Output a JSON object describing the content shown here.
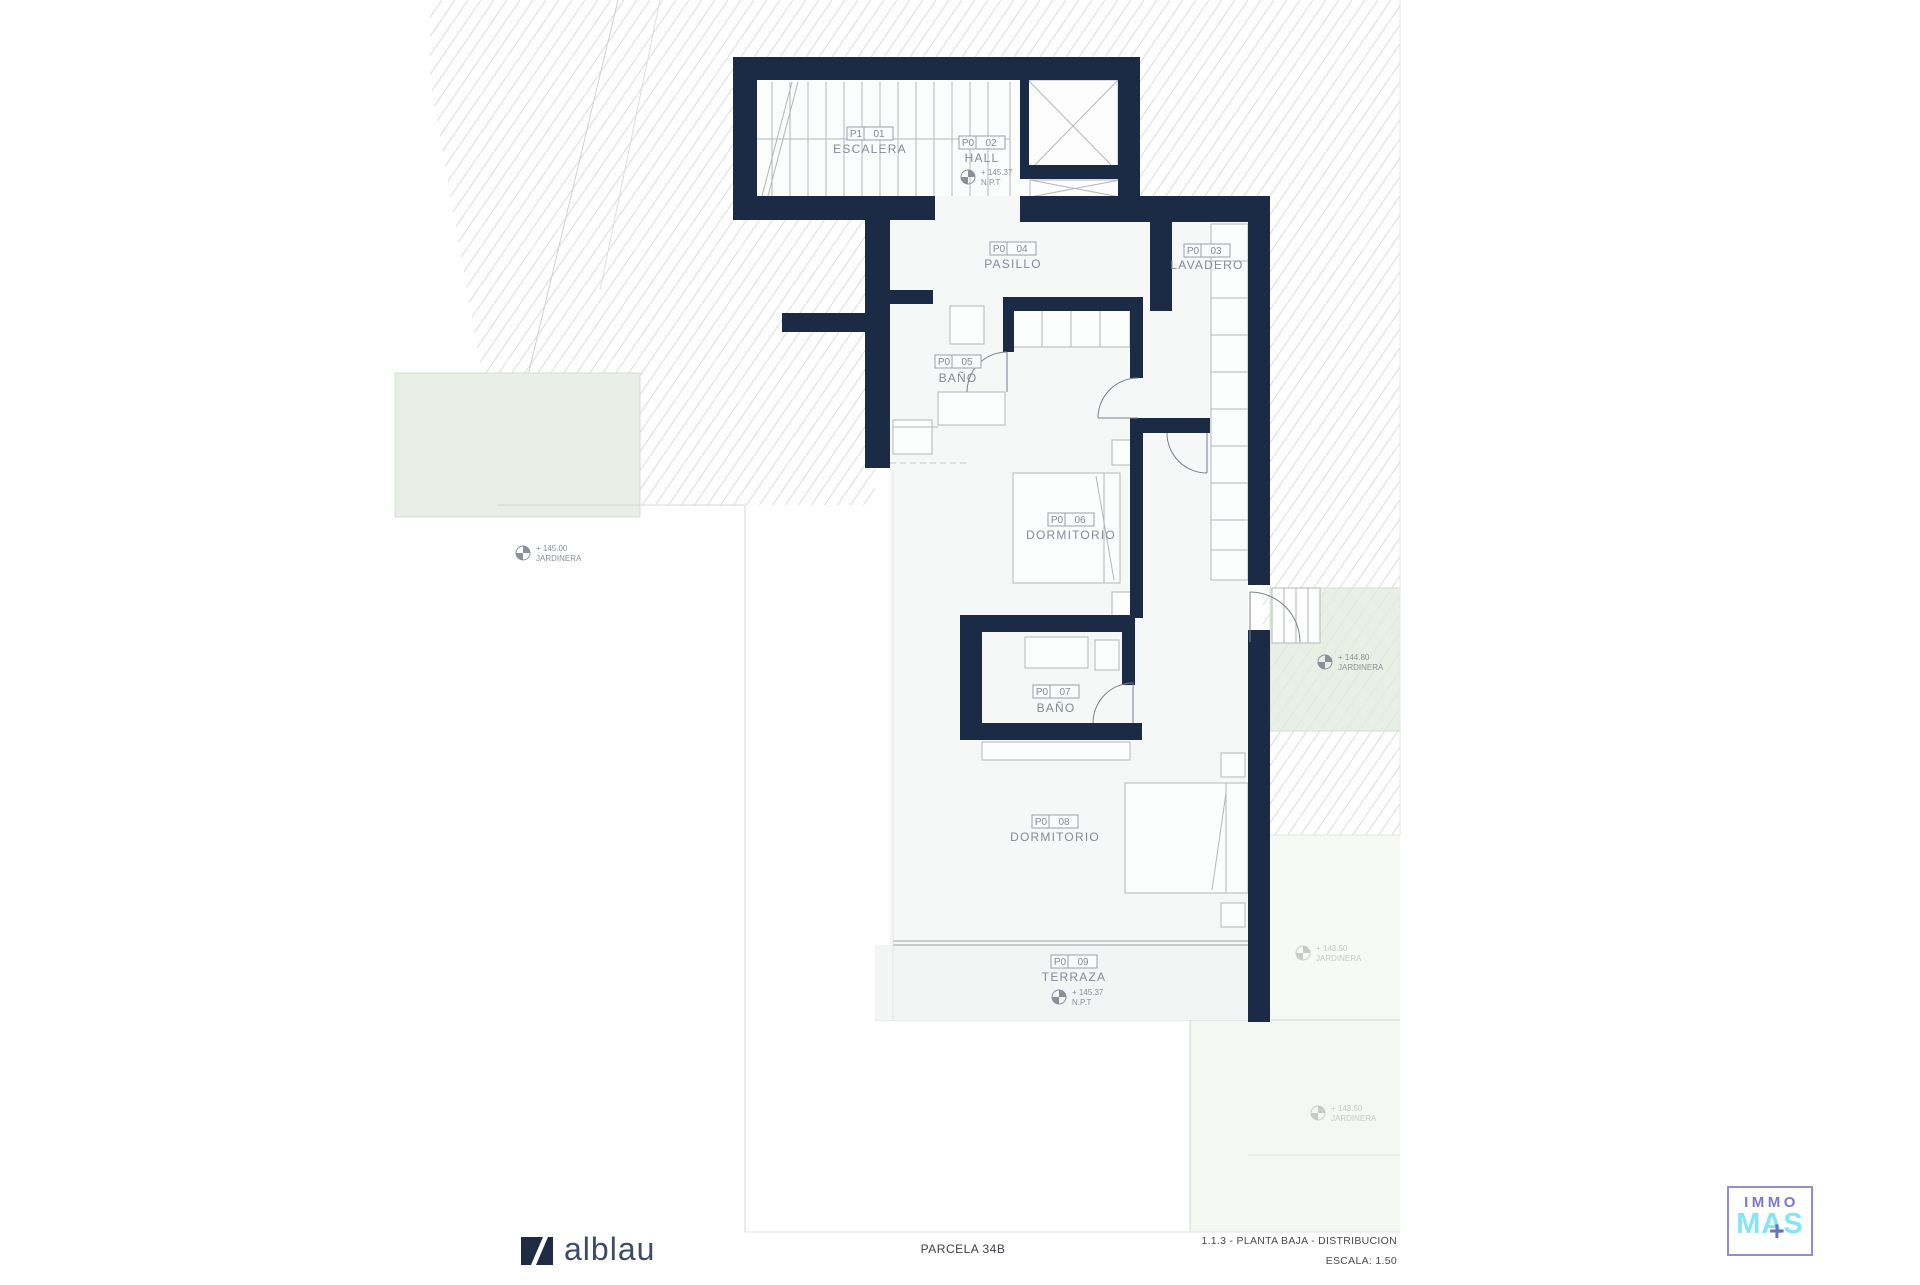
{
  "plan": {
    "rooms": [
      {
        "code": "P1",
        "num": "01",
        "name": "ESCALERA"
      },
      {
        "code": "P0",
        "num": "02",
        "name": "HALL"
      },
      {
        "code": "P0",
        "num": "03",
        "name": "LAVADERO"
      },
      {
        "code": "P0",
        "num": "04",
        "name": "PASILLO"
      },
      {
        "code": "P0",
        "num": "05",
        "name": "BAÑO"
      },
      {
        "code": "P0",
        "num": "06",
        "name": "DORMITORIO"
      },
      {
        "code": "P0",
        "num": "07",
        "name": "BAÑO"
      },
      {
        "code": "P0",
        "num": "08",
        "name": "DORMITORIO"
      },
      {
        "code": "P0",
        "num": "09",
        "name": "TERRAZA"
      }
    ],
    "levels": [
      {
        "value": "+ 145.37",
        "label": "N.P.T"
      },
      {
        "value": "+ 145.37",
        "label": "N.P.T"
      },
      {
        "value": "+ 145.00",
        "label": "JARDINERA"
      },
      {
        "value": "+ 144.80",
        "label": "JARDINERA"
      },
      {
        "value": "+ 143.50",
        "label": "JARDINERA"
      },
      {
        "value": "+ 143.50",
        "label": "JARDINERA"
      }
    ]
  },
  "titleblock": {
    "brand": "alblau",
    "parcel": "PARCELA 34B",
    "sheet": "1.1.3 - PLANTA BAJA - DISTRIBUCION",
    "scale": "ESCALA: 1.50"
  },
  "watermark": {
    "line1": "IMMO",
    "line2": "MAS",
    "plus": "+"
  },
  "colors": {
    "wall": "#1b2b45",
    "label": "#848b95",
    "green": "#e9eee7",
    "purple": "#7b79c4",
    "cyan": "#82e6f3"
  }
}
